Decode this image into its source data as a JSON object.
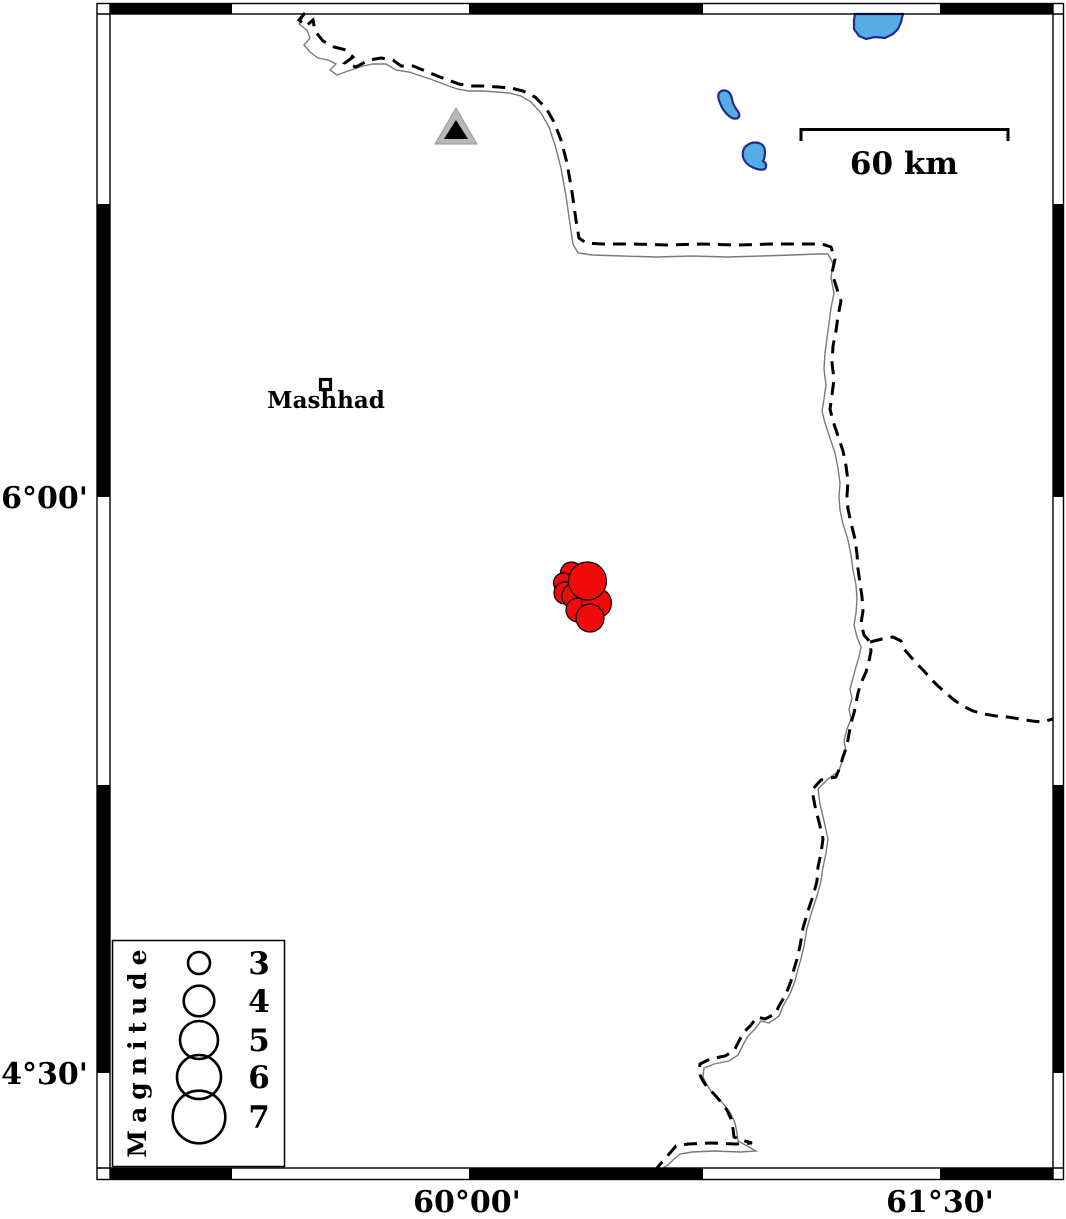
{
  "map_labels": {
    "lat": [
      {
        "text": "36°00'"
      },
      {
        "text": "34°30'"
      }
    ],
    "lon": [
      {
        "text": "60°00'"
      },
      {
        "text": "61°30'"
      }
    ]
  },
  "scale_bar": {
    "label": "60 km"
  },
  "city": {
    "label": "Mashhad"
  },
  "legend": {
    "title": "Magnitude",
    "entries": [
      {
        "label": "3",
        "cy": 963,
        "r": 11
      },
      {
        "label": "4",
        "cy": 1001,
        "r": 15.3
      },
      {
        "label": "5",
        "cy": 1040,
        "r": 19
      },
      {
        "label": "6",
        "cy": 1077,
        "r": 22
      },
      {
        "label": "7",
        "cy": 1117,
        "r": 26.3
      }
    ]
  },
  "earthquakes": [
    {
      "x": 571.5,
      "y": 573,
      "r": 11
    },
    {
      "x": 563.5,
      "y": 583,
      "r": 10
    },
    {
      "x": 565,
      "y": 593,
      "r": 11
    },
    {
      "x": 575,
      "y": 596,
      "r": 13
    },
    {
      "x": 578,
      "y": 610,
      "r": 12
    },
    {
      "x": 596.5,
      "y": 603,
      "r": 15
    },
    {
      "x": 587.5,
      "y": 581,
      "r": 19
    },
    {
      "x": 590,
      "y": 618,
      "r": 14
    }
  ],
  "colors": {
    "ink": "#000000",
    "quake_red": "#f20a0a",
    "lake_fill": "#55ade3",
    "lake_outline": "#1f2b8f",
    "triangle_fill": "#b8b8b8",
    "triangle_inner": "#000000",
    "river": "#7a7a7a",
    "background": "#ffffff"
  }
}
